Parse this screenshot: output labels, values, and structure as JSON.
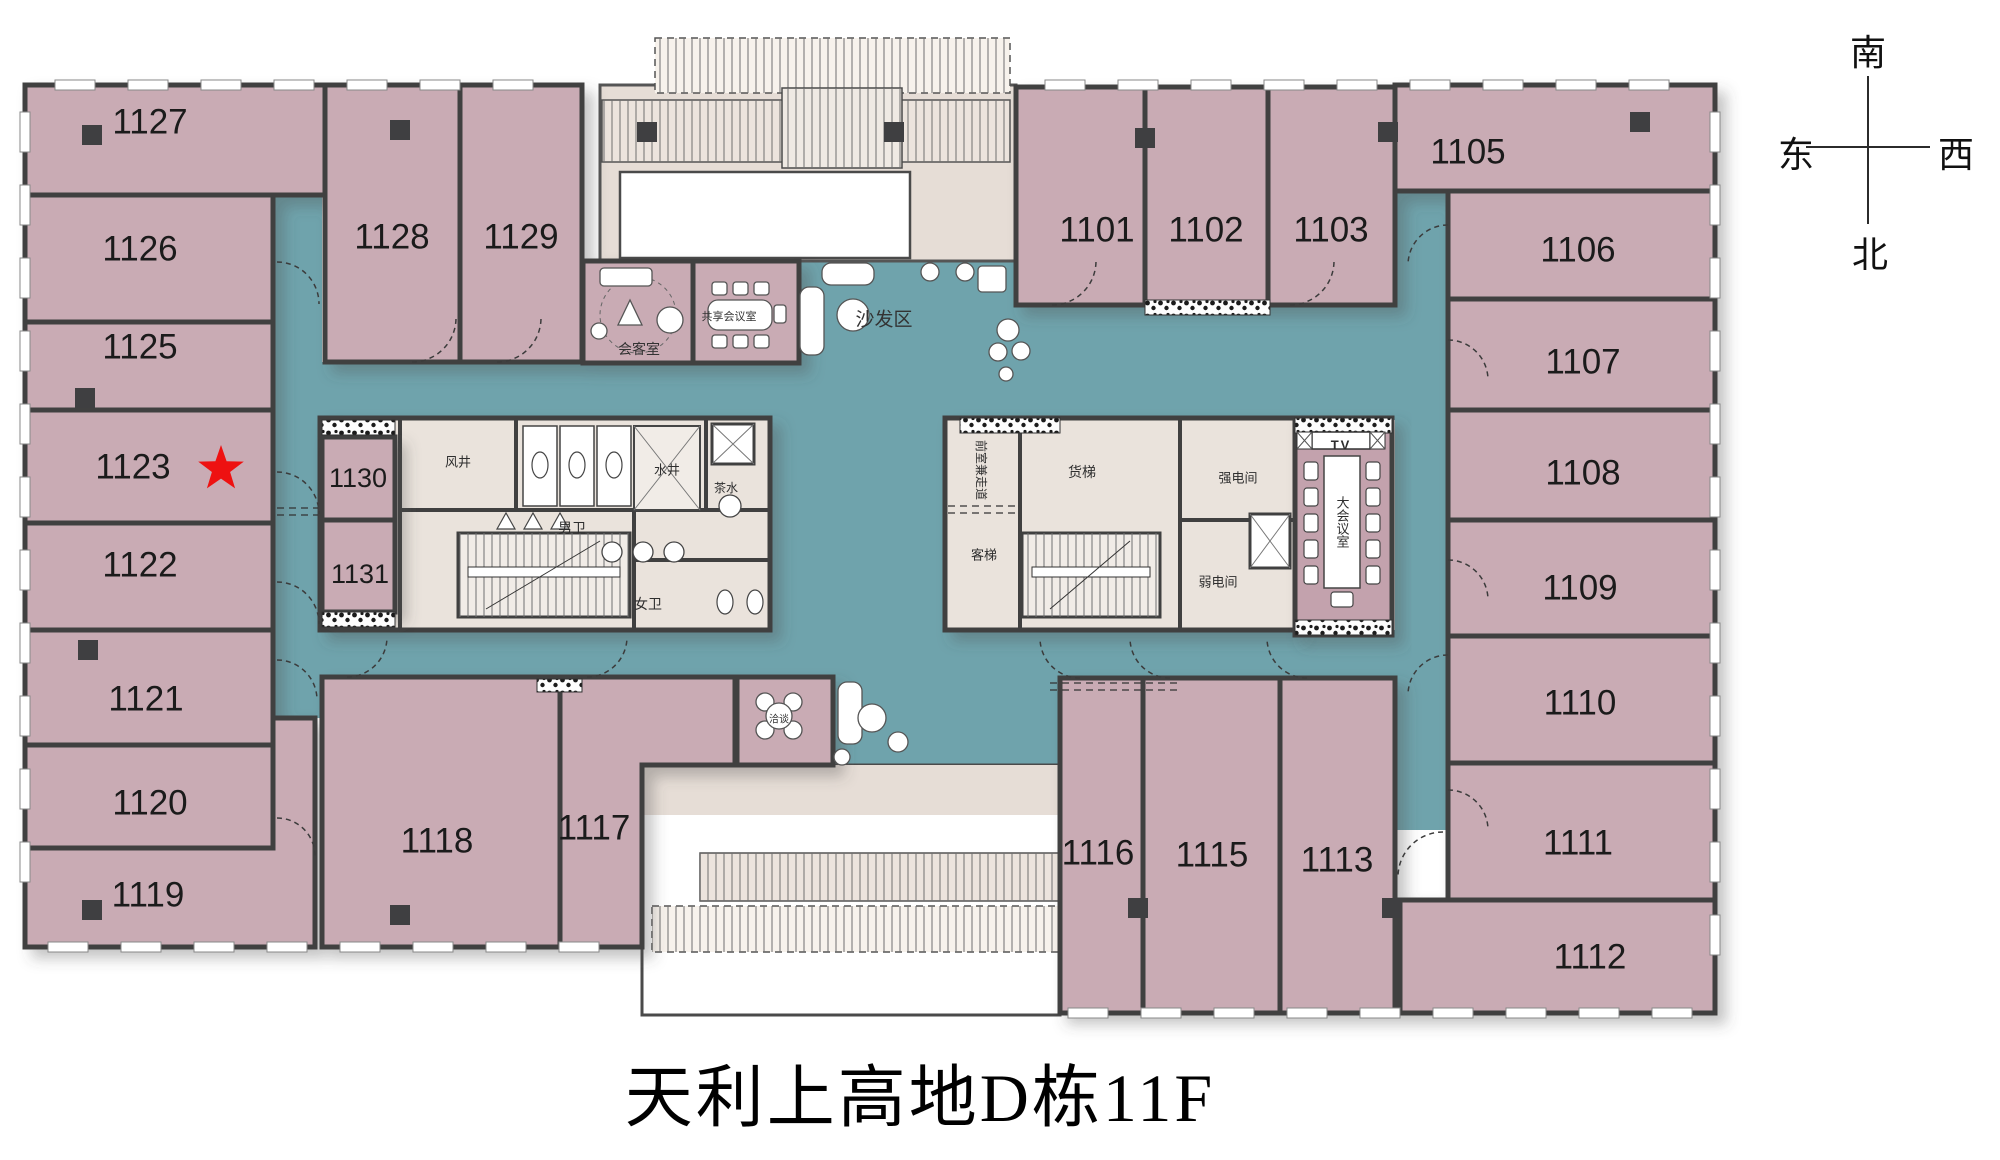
{
  "title": "天利上高地D栋11F",
  "compass": {
    "south": "南",
    "east": "东",
    "west": "西",
    "north": "北"
  },
  "colors": {
    "room": "#c9abb4",
    "meeting_room": "#c3a2ad",
    "corridor": "#6fa3ac",
    "wall": "#3f3f41",
    "core": "#eae3dc",
    "atrium": "#e6ddd6",
    "band": "#ece4dd",
    "star": "#ee1111",
    "label": "#1b1b1b"
  },
  "floor_plan": {
    "rooms": [
      {
        "id": "1127",
        "rect": [
          25,
          85,
          300,
          110
        ],
        "lx": 150,
        "ly": 122
      },
      {
        "id": "1126",
        "rect": [
          25,
          195,
          248,
          127
        ],
        "lx": 140,
        "ly": 249
      },
      {
        "id": "1125",
        "rect": [
          25,
          322,
          248,
          88
        ],
        "lx": 140,
        "ly": 347
      },
      {
        "id": "1123",
        "rect": [
          25,
          410,
          248,
          113
        ],
        "lx": 133,
        "ly": 467
      },
      {
        "id": "1122",
        "rect": [
          25,
          523,
          248,
          107
        ],
        "lx": 140,
        "ly": 565
      },
      {
        "id": "1121",
        "rect": [
          25,
          630,
          248,
          115
        ],
        "lx": 146,
        "ly": 699
      },
      {
        "id": "1120",
        "rect": [
          25,
          745,
          248,
          103
        ],
        "lx": 150,
        "ly": 803
      },
      {
        "id": "1119",
        "path": "M25,848 L273,848 L273,718 L315,718 L315,947 L25,947 Z",
        "lx": 148,
        "ly": 895
      },
      {
        "id": "1128",
        "rect": [
          325,
          85,
          135,
          277
        ],
        "lx": 392,
        "ly": 237
      },
      {
        "id": "1129",
        "rect": [
          460,
          85,
          122,
          277
        ],
        "lx": 521,
        "ly": 237
      },
      {
        "id": "1101",
        "rect": [
          1016,
          87,
          129,
          218
        ],
        "lx": 1097,
        "ly": 230
      },
      {
        "id": "1102",
        "rect": [
          1145,
          87,
          123,
          218
        ],
        "lx": 1206,
        "ly": 230
      },
      {
        "id": "1103",
        "rect": [
          1268,
          87,
          127,
          218
        ],
        "lx": 1331,
        "ly": 230
      },
      {
        "id": "1105",
        "rect": [
          1395,
          85,
          320,
          106
        ],
        "lx": 1468,
        "ly": 152
      },
      {
        "id": "1106",
        "rect": [
          1448,
          191,
          267,
          108
        ],
        "lx": 1578,
        "ly": 250
      },
      {
        "id": "1107",
        "rect": [
          1448,
          299,
          267,
          111
        ],
        "lx": 1583,
        "ly": 362
      },
      {
        "id": "1108",
        "rect": [
          1448,
          410,
          267,
          110
        ],
        "lx": 1583,
        "ly": 473
      },
      {
        "id": "1109",
        "rect": [
          1448,
          520,
          267,
          116
        ],
        "lx": 1580,
        "ly": 588
      },
      {
        "id": "1110",
        "rect": [
          1448,
          636,
          267,
          127
        ],
        "lx": 1580,
        "ly": 703
      },
      {
        "id": "1111",
        "rect": [
          1448,
          763,
          267,
          137
        ],
        "lx": 1578,
        "ly": 843
      },
      {
        "id": "1112",
        "rect": [
          1400,
          900,
          315,
          113
        ],
        "lx": 1590,
        "ly": 957
      },
      {
        "id": "1118",
        "rect": [
          322,
          677,
          238,
          270
        ],
        "lx": 437,
        "ly": 841
      },
      {
        "id": "1117",
        "path": "M560,677 L735,677 L735,765 L642,765 L642,947 L560,947 Z",
        "lx": 594,
        "ly": 828
      },
      {
        "id": "1116",
        "rect": [
          1060,
          678,
          83,
          335
        ],
        "lx": 1098,
        "ly": 853
      },
      {
        "id": "1115",
        "rect": [
          1143,
          678,
          137,
          335
        ],
        "lx": 1212,
        "ly": 855
      },
      {
        "id": "1113",
        "rect": [
          1280,
          678,
          115,
          335
        ],
        "lx": 1337,
        "ly": 860
      },
      {
        "id": "1130",
        "rect": [
          322,
          437,
          73,
          83
        ],
        "lx": 358,
        "ly": 478,
        "fs": 27
      },
      {
        "id": "1131",
        "rect": [
          322,
          520,
          73,
          92
        ],
        "lx": 360,
        "ly": 574,
        "fs": 27
      }
    ],
    "core_labels": [
      {
        "text": "风井",
        "x": 458,
        "y": 462,
        "fs": 13
      },
      {
        "text": "水井",
        "x": 667,
        "y": 470,
        "fs": 13
      },
      {
        "text": "男卫",
        "x": 572,
        "y": 528,
        "fs": 14
      },
      {
        "text": "女卫",
        "x": 648,
        "y": 604,
        "fs": 14
      },
      {
        "text": "茶水",
        "x": 726,
        "y": 488,
        "fs": 12
      },
      {
        "text": "货梯",
        "x": 1082,
        "y": 472,
        "fs": 14
      },
      {
        "text": "客梯",
        "x": 984,
        "y": 555,
        "fs": 13
      },
      {
        "text": "强电间",
        "x": 1238,
        "y": 478,
        "fs": 13
      },
      {
        "text": "弱电间",
        "x": 1218,
        "y": 582,
        "fs": 13
      },
      {
        "text": "前室兼走道",
        "x": 981,
        "y": 470,
        "fs": 12,
        "rot": 90
      },
      {
        "text": "TV",
        "x": 1341,
        "y": 445,
        "fs": 13,
        "bold": true
      },
      {
        "text": "大会议室",
        "x": 1342,
        "y": 522,
        "fs": 13,
        "vert": true
      }
    ],
    "area_labels": [
      {
        "text": "会客室",
        "x": 639,
        "y": 349,
        "fs": 14
      },
      {
        "text": "共享会议室",
        "x": 729,
        "y": 317,
        "fs": 11
      },
      {
        "text": "沙发区",
        "x": 884,
        "y": 320,
        "fs": 19
      },
      {
        "text": "洽谈",
        "x": 779,
        "y": 720,
        "fs": 10
      }
    ],
    "star": {
      "x": 221,
      "y": 469,
      "in_room": "1123"
    }
  }
}
